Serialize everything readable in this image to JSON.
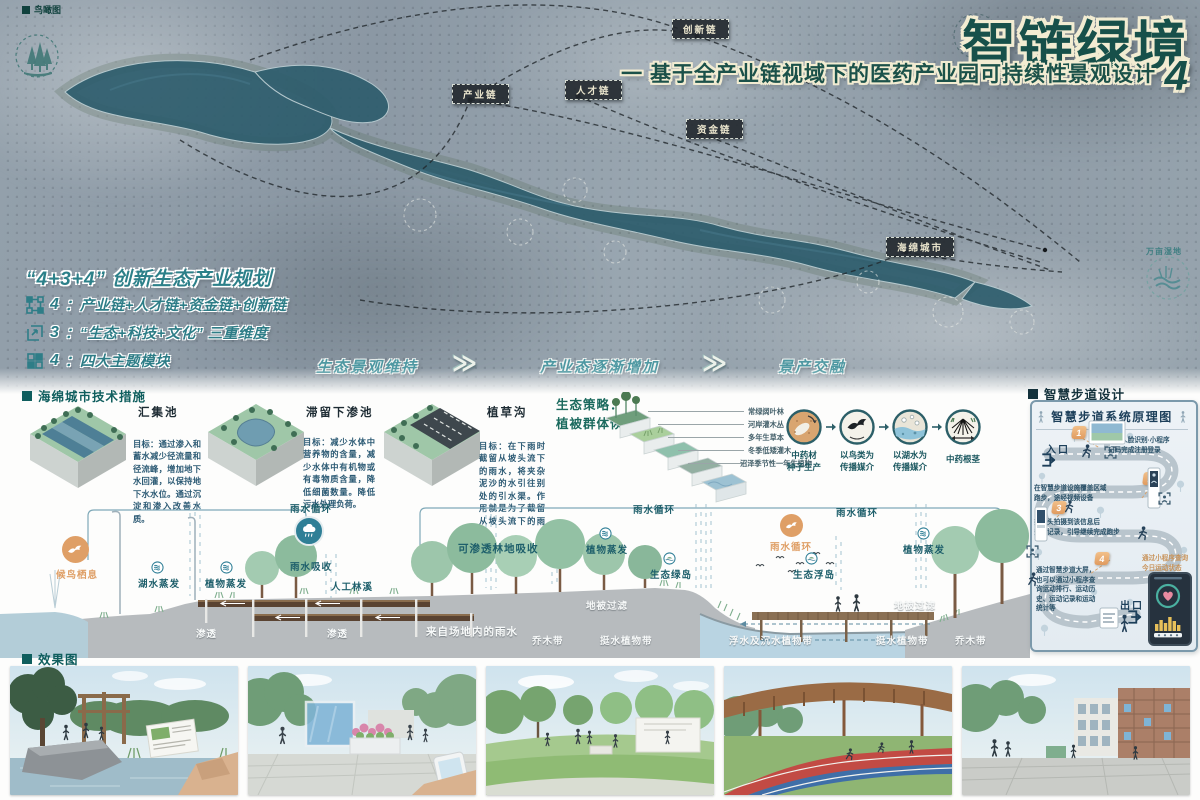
{
  "header": {
    "corner_label": "鸟瞰图",
    "title": "智链绿境",
    "subtitle": "一 基于全产业链视域下的医药产业园可持续性景观设计",
    "page_number": "4"
  },
  "colors": {
    "accent_teal": "#17504a",
    "cream": "#f2ecd2",
    "orange": "#df9f66",
    "panel_navy": "#1c3f5a"
  },
  "map": {
    "chains": [
      {
        "label": "产业链"
      },
      {
        "label": "人才链"
      },
      {
        "label": "资金链"
      },
      {
        "label": "创新链"
      },
      {
        "label": "海绵城市"
      }
    ],
    "wetland_label": "万亩湿地",
    "planning": {
      "title": "“4+3+4” 创新生态产业规划",
      "items": [
        {
          "num": "4",
          "text": "：产业链+人才链+资金链+创新链"
        },
        {
          "num": "3",
          "text": "：“生态+科技+文化” 三重维度"
        },
        {
          "num": "4",
          "text": "：四大主题模块"
        }
      ]
    },
    "phases": [
      {
        "label": "生态景观维持"
      },
      {
        "label": "产业态逐渐增加"
      },
      {
        "label": "景产交融"
      }
    ],
    "chevron": "≫"
  },
  "sponge": {
    "header": "海绵城市技术措施",
    "techniques": [
      {
        "name": "汇集池",
        "desc": "目标：通过渗入和蓄水减少径流量和径流峰，增加地下水回灌，以保持地下水水位。通过沉淀和渗入改善水质。"
      },
      {
        "name": "滞留下渗池",
        "desc": "目标：减少水体中营养物的含量，减少水体中有机物或有毒物质含量，降低细菌数量。降低污水处理负荷。"
      },
      {
        "name": "植草沟",
        "desc": "目标：在下雨时截留从坡头流下的雨水，将夹杂泥沙的水引往别处的引水渠。作用就是为了截留从坡头流下的雨水。"
      }
    ],
    "ecology": {
      "title_line1": "生态策略：",
      "title_line2": "植被群体恢复",
      "layers": [
        {
          "label": "常绿阔叶林"
        },
        {
          "label": "河岸灌木丛"
        },
        {
          "label": "多年生草本"
        },
        {
          "label": "冬季低矮灌木"
        },
        {
          "label": "沼泽季节性一年生植物"
        }
      ],
      "cycle": [
        {
          "label": "中药材\n种子生产"
        },
        {
          "label": "以鸟类为\n传播媒介"
        },
        {
          "label": "以湖水为\n传播媒介"
        },
        {
          "label": "中药根茎"
        }
      ]
    }
  },
  "section": {
    "bird_habitat": "候鸟栖息",
    "lake_evaporation": "湖水蒸发",
    "plant_evaporation_1": "植物蒸发",
    "rain_cycle_1": "雨水循环",
    "rain_absorb": "雨水吸收",
    "artificial_stream": "人工林溪",
    "infiltration_1": "渗透",
    "infiltration_2": "渗透",
    "site_rainwater": "来自场地内的雨水",
    "permeable_forest": "可渗透林地吸收",
    "rain_cycle_2": "雨水循环",
    "plant_evaporation_2": "植物蒸发",
    "eco_green_island": "生态绿岛",
    "ground_filter_1": "地被过滤",
    "tree_belt_1": "乔木带",
    "emergent_belt_1": "挺水植物带",
    "floating_belt": "浮水及沉水植物带",
    "rain_cycle_3": "雨水循环",
    "plant_evaporation_3": "植物蒸发",
    "eco_floating_island": "生态浮岛",
    "rain_cycle_4": "雨水循环",
    "ground_filter_2": "地被过滤",
    "emergent_belt_2": "挺水植物带",
    "tree_belt_2": "乔木带"
  },
  "smart": {
    "header": "智慧步道设计",
    "title": "智慧步道系统原理图",
    "entrance": "入口",
    "exit": "出口",
    "steps": [
      {
        "num": "1",
        "text": "通过人脸识别·小程序\n扫码完成注册登录"
      },
      {
        "num": "2",
        "text": "在智慧步道设施覆盖区域\n跑步，途经视频设备"
      },
      {
        "num": "3",
        "text": "摄像头拍摄到该信息后\n完成记录，引导继续完成跑步"
      },
      {
        "num": "4",
        "text": "通过智慧步道大屏，\n也可以通过小程序查\n询运动排行、运动历\n史、运动记录和运动\n统计等"
      }
    ],
    "phone_note": "通过小程序查询\n今日运动状态"
  },
  "renders": {
    "header": "效果图"
  }
}
